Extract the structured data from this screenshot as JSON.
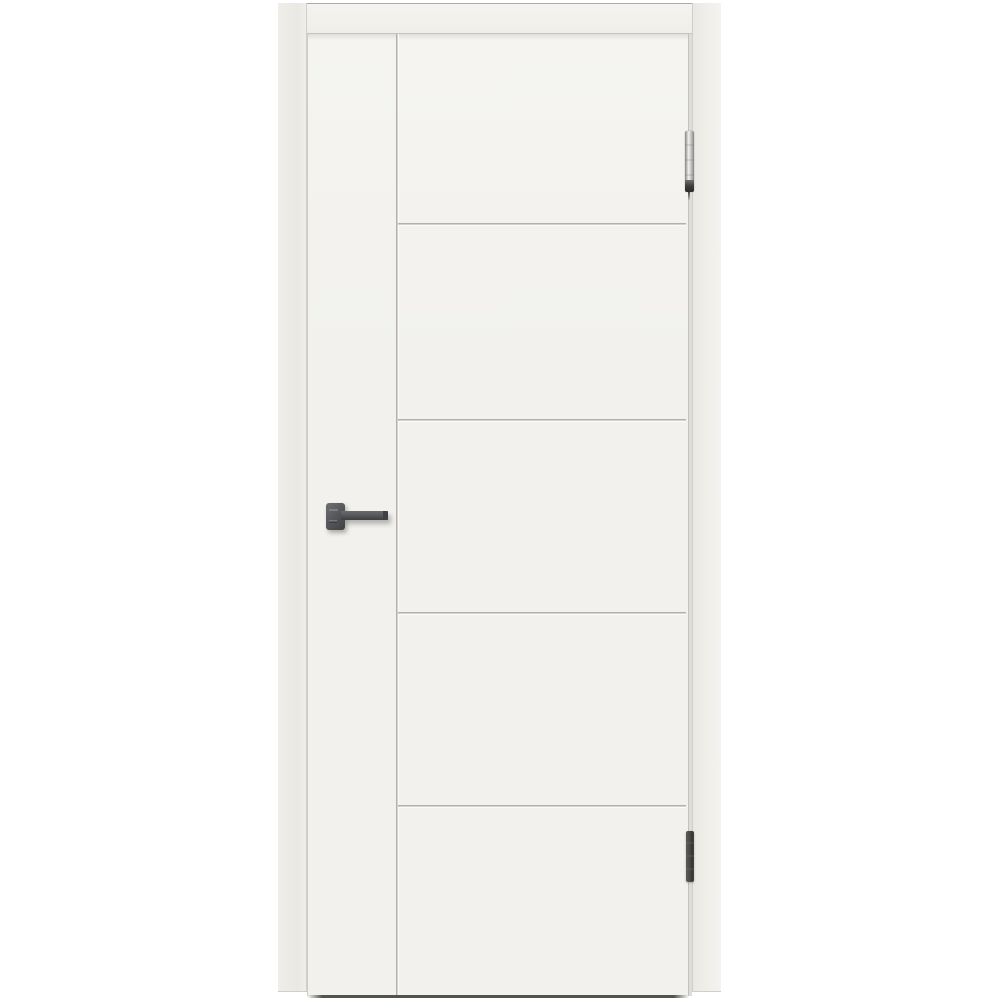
{
  "scene": {
    "description": "Product photograph of a closed white enamel interior door in a matching white frame on a plain white background. The leaf has a flat left stile separated by one vertical V-groove and five equal flat panels divided by four horizontal V-grooves. A dark gunmetal square-rosette lever handle sits on the left stile; two slim hinges are on the right edge.",
    "background_color": "#ffffff"
  },
  "door": {
    "finish_name": "white enamel",
    "panel_count": 5,
    "horizontal_groove_count": 4,
    "vertical_groove_count": 1
  },
  "hardware": {
    "handle_type": "square-rosette lever handle",
    "handle_finish": "matte gunmetal",
    "hinge_count": 2,
    "top_hinge_finish": "polished chrome with dark bottom cap",
    "bottom_hinge_finish": "dark gunmetal"
  },
  "colors": {
    "background": "#ffffff",
    "frame-face": "#f0eee9",
    "frame-face-dark": "#eae8e3",
    "frame-edge": "#d2cfca",
    "lintel-face": "#f4f3f0",
    "lintel-top-line": "#adaba6",
    "lintel-bottom-line": "#c7c4bf",
    "leaf-face": "#f2f1ed",
    "leaf-face-light": "#f5f4f1",
    "leaf-edge-left": "#cfccc7",
    "leaf-edge-right": "#c5c2bd",
    "gap": "#dfddd8",
    "groove-shadow": "#b4b1ac",
    "groove-highlight": "#fcfbf9",
    "bottom-shadow": "#54524d",
    "handle-body": "#58595c",
    "handle-dark": "#3f4043",
    "handle-light": "#85868a",
    "hinge-chrome-light": "#f1f1ef",
    "hinge-chrome-mid": "#b5b5b3",
    "hinge-chrome-dark": "#858583",
    "hinge-cap": "#3a3a3c",
    "hinge-dark-body": "#4b4a48",
    "hinge-dark-edge": "#343432"
  }
}
